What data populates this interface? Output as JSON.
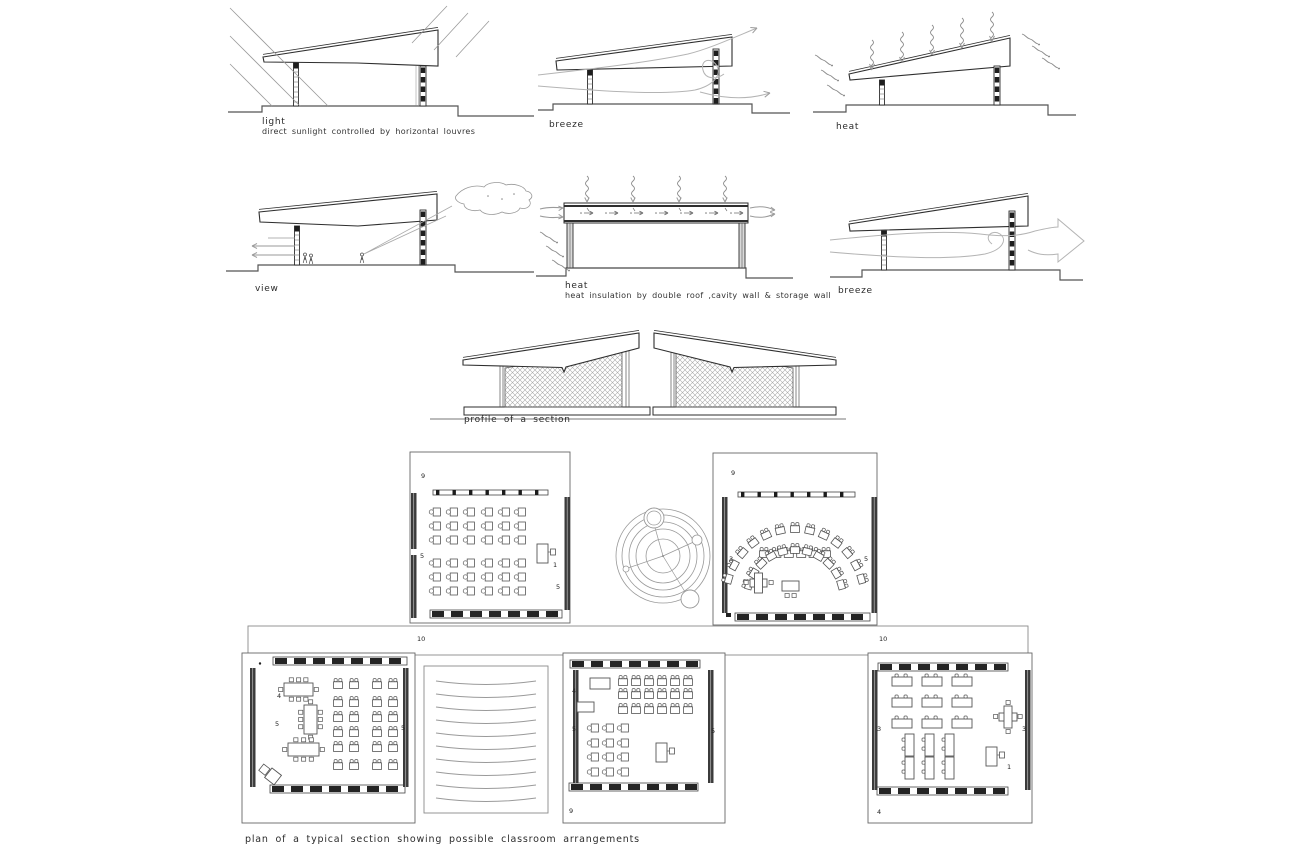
{
  "colors": {
    "paper": "#ffffff",
    "ink": "#2b2b2b",
    "pencil": "#9a9a9a"
  },
  "section_studies": [
    {
      "label": "light",
      "sublabel": "direct sunlight controlled by horizontal louvres"
    },
    {
      "label": "breeze",
      "sublabel": ""
    },
    {
      "label": "heat",
      "sublabel": ""
    },
    {
      "label": "view",
      "sublabel": ""
    },
    {
      "label": "heat",
      "sublabel": "heat insulation by double roof ,cavity wall & storage wall"
    },
    {
      "label": "breeze",
      "sublabel": ""
    }
  ],
  "profile": {
    "label": "profile of a section"
  },
  "plan": {
    "caption": "plan of a typical section showing possible classroom arrangements",
    "corridor_labels": [
      "10",
      "10"
    ],
    "unit_numbers": {
      "unit_a": [
        "9",
        "5",
        "5",
        "1"
      ],
      "unit_b": [
        "9",
        "3",
        "5"
      ],
      "unit_c": [
        "4",
        "5",
        "5"
      ],
      "unit_d": [
        "4",
        "5",
        "5",
        "9"
      ],
      "unit_e": [
        "3",
        "3",
        "1",
        "4"
      ]
    }
  }
}
